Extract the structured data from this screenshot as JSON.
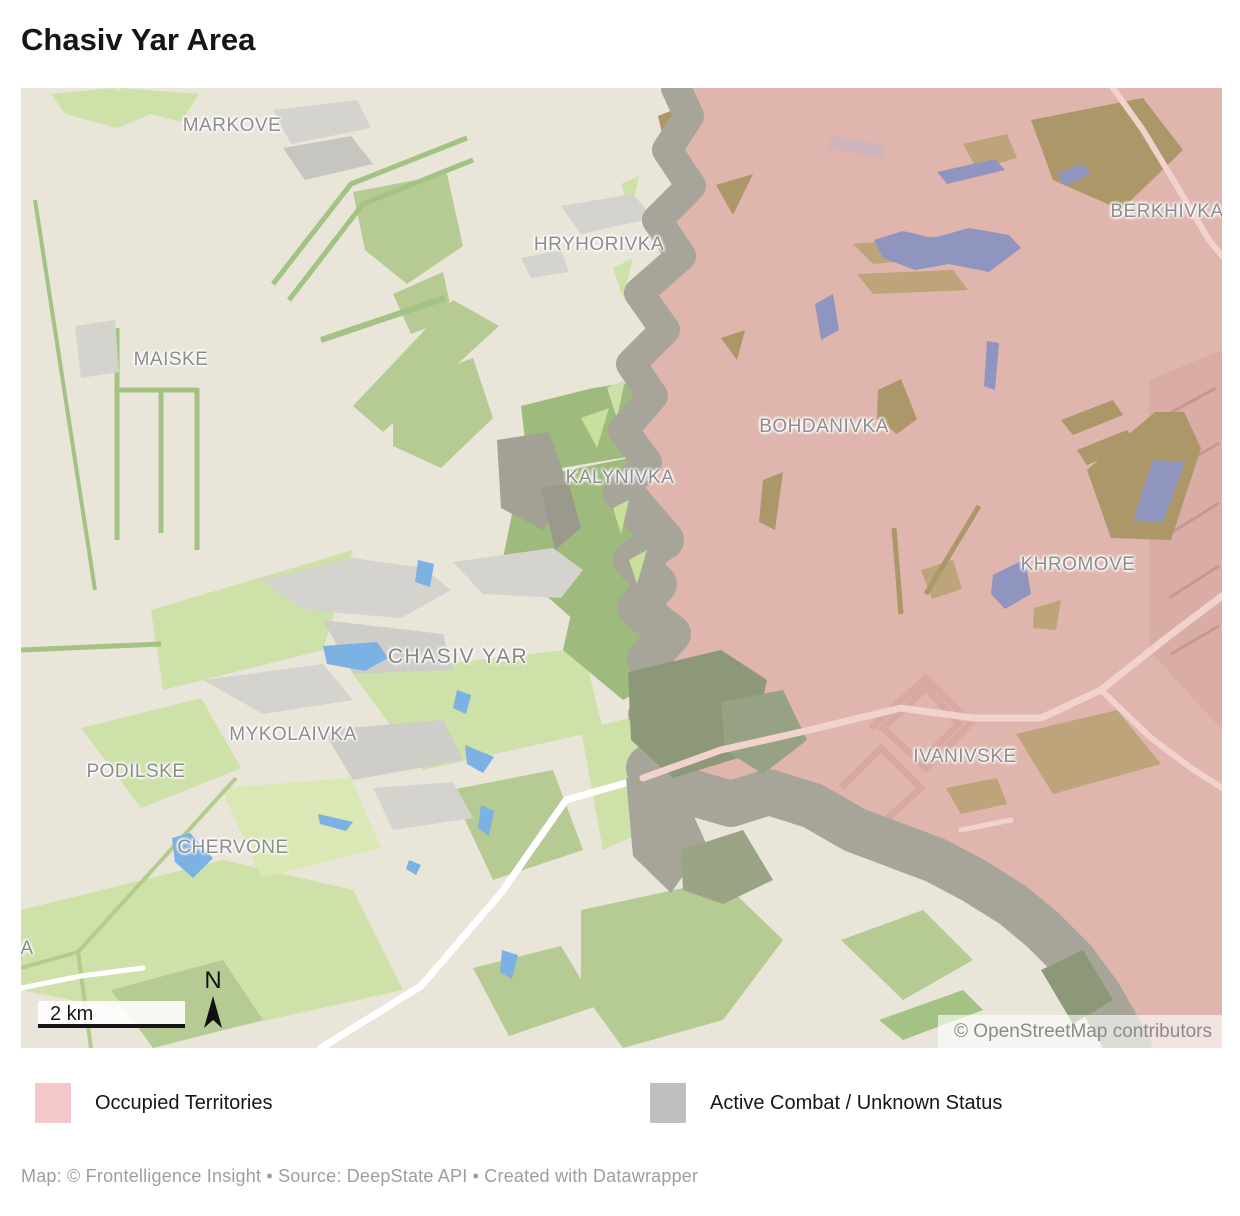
{
  "title": "Chasiv Yar Area",
  "map": {
    "labels": [
      {
        "name": "MARKOVE"
      },
      {
        "name": "HRYHORIVKA"
      },
      {
        "name": "MAISKE"
      },
      {
        "name": "BERKHIVKA"
      },
      {
        "name": "BOHDANIVKA"
      },
      {
        "name": "KALYNIVKA"
      },
      {
        "name": "KHROMOVE"
      },
      {
        "name": "CHASIV YAR"
      },
      {
        "name": "MYKOLAIVKA"
      },
      {
        "name": "PODILSKE"
      },
      {
        "name": "IVANIVSKE"
      },
      {
        "name": "CHERVONE"
      },
      {
        "name": "A"
      }
    ],
    "scale_label": "2 km",
    "north_label": "N",
    "attribution": "© OpenStreetMap contributors"
  },
  "legend": {
    "items": [
      {
        "label": "Occupied Territories",
        "color": "#f4c8c8"
      },
      {
        "label": "Active Combat / Unknown Status",
        "color": "#bfbfbf"
      }
    ]
  },
  "footer": "Map: © Frontelligence Insight • Source: DeepState API • Created with Datawrapper",
  "colors": {
    "map_background": "#e9e5d9",
    "occupied_fill": "#dfb5ad",
    "combat_band": "#a7a599",
    "field_light_green": "#cde1a9",
    "forest_sage": "#9eba7d",
    "urban_gray": "#d5d3cd",
    "water_blue": "#7cb1e3",
    "water_occupied": "#9095c0",
    "tan_field": "#bda47a",
    "label_gray": "#8d8d8d"
  }
}
